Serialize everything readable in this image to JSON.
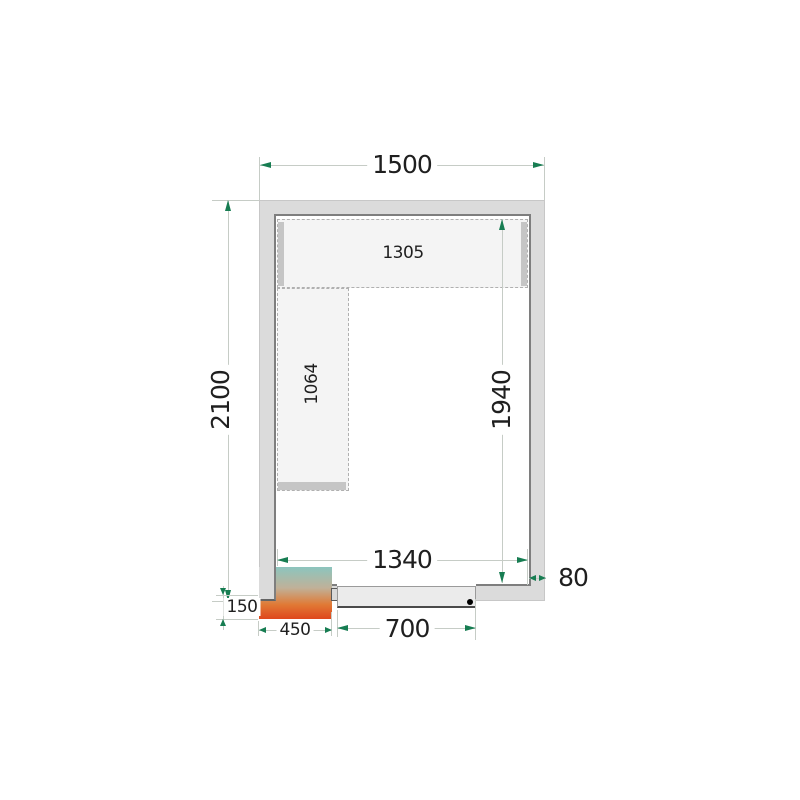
{
  "drawing_type": "cold-room-floor-plan-top-view",
  "dims": {
    "outer_width": "1500",
    "outer_height": "2100",
    "inner_width": "1340",
    "inner_height": "1940",
    "wall_thickness": "80",
    "door_width": "700",
    "unit_width": "450",
    "unit_depth": "150",
    "shelf_top_length": "1305",
    "shelf_side_length": "1064"
  },
  "colors": {
    "arrow": "#177d52",
    "dimline": "#c6ccc6",
    "wallfill": "#dbdbdb",
    "wallline": "#c7c7c7",
    "wallinner": "#7e7e7e",
    "shelffill": "#f4f4f4",
    "shelfdash": "#b0b0b0",
    "shelfbar": "#c5c5c5",
    "doorfill": "#ebebeb",
    "doorline": "#9a9a9a",
    "unita": "#8cc5be",
    "unitb": "#c0b199",
    "unitc": "#e07a36",
    "unitd": "#df471c",
    "ink": "#1f1f1f"
  }
}
